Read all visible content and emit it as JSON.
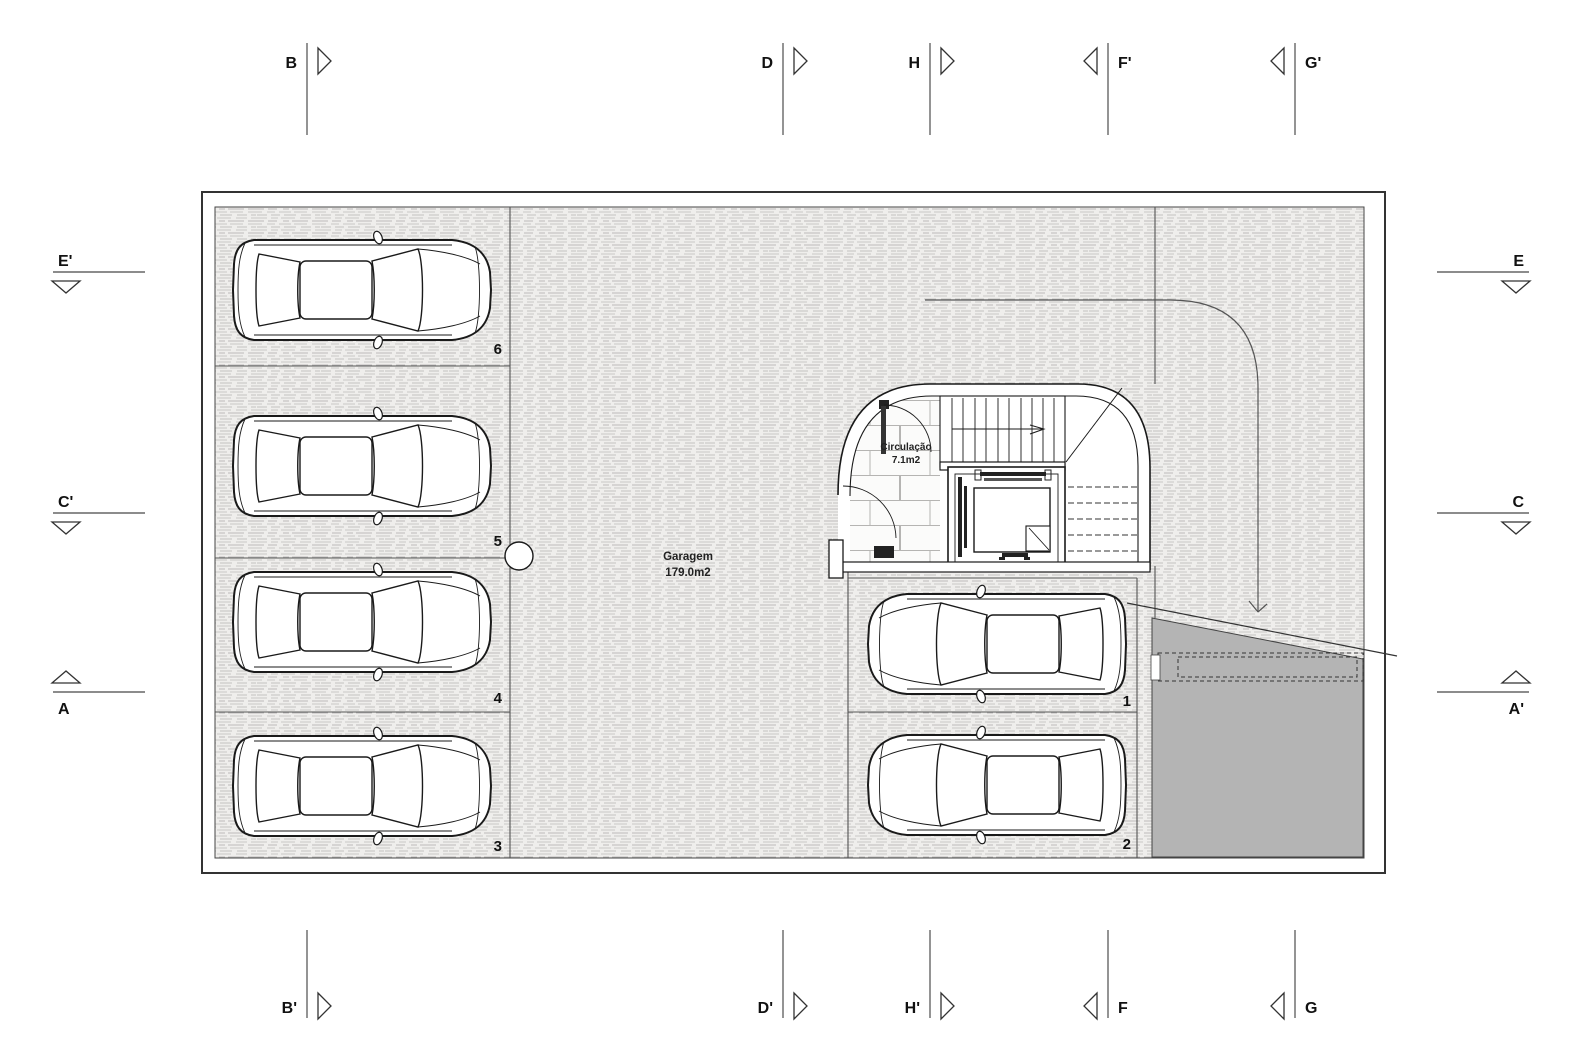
{
  "drawing_type": "garage floor plan",
  "rooms": {
    "garage": {
      "name": "Garagem",
      "area": "179.0m2"
    },
    "circulation": {
      "name": "Circulação",
      "area": "7.1m2"
    }
  },
  "parking": {
    "spaces": [
      {
        "number": "1"
      },
      {
        "number": "2"
      },
      {
        "number": "3"
      },
      {
        "number": "4"
      },
      {
        "number": "5"
      },
      {
        "number": "6"
      }
    ]
  },
  "markers": {
    "top": [
      {
        "label": "B"
      },
      {
        "label": "D"
      },
      {
        "label": "H"
      },
      {
        "label": "F'"
      },
      {
        "label": "G'"
      }
    ],
    "bottom": [
      {
        "label": "B'"
      },
      {
        "label": "D'"
      },
      {
        "label": "H'"
      },
      {
        "label": "F"
      },
      {
        "label": "G"
      }
    ],
    "left": [
      {
        "label": "E'"
      },
      {
        "label": "C'"
      },
      {
        "label": "A"
      }
    ],
    "right": [
      {
        "label": "E"
      },
      {
        "label": "C"
      },
      {
        "label": "A'"
      }
    ]
  },
  "colors": {
    "ramp_gray": "#b4b4b4",
    "line_dark": "#1a1a1a",
    "hatch_gray": "#c6c5c3",
    "paper": "#ffffff"
  }
}
